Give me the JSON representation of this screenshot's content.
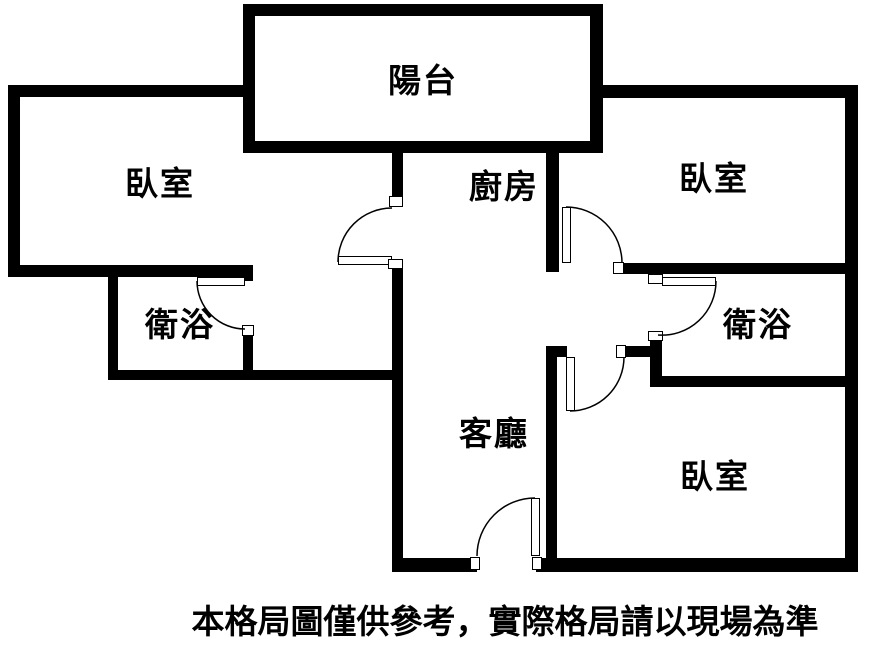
{
  "rooms": {
    "balcony": {
      "label": "陽台"
    },
    "bedroom_left": {
      "label": "臥室"
    },
    "kitchen": {
      "label": "廚房"
    },
    "bedroom_top_right": {
      "label": "臥室"
    },
    "bath_left": {
      "label": "衛浴"
    },
    "bath_right": {
      "label": "衛浴"
    },
    "living_room": {
      "label": "客廳"
    },
    "bedroom_bottom_right": {
      "label": "臥室"
    }
  },
  "footer": {
    "disclaimer": "本格局圖僅供參考，實際格局請以現場為準"
  },
  "colors": {
    "wall": "#000000",
    "background": "#ffffff",
    "text": "#000000"
  }
}
